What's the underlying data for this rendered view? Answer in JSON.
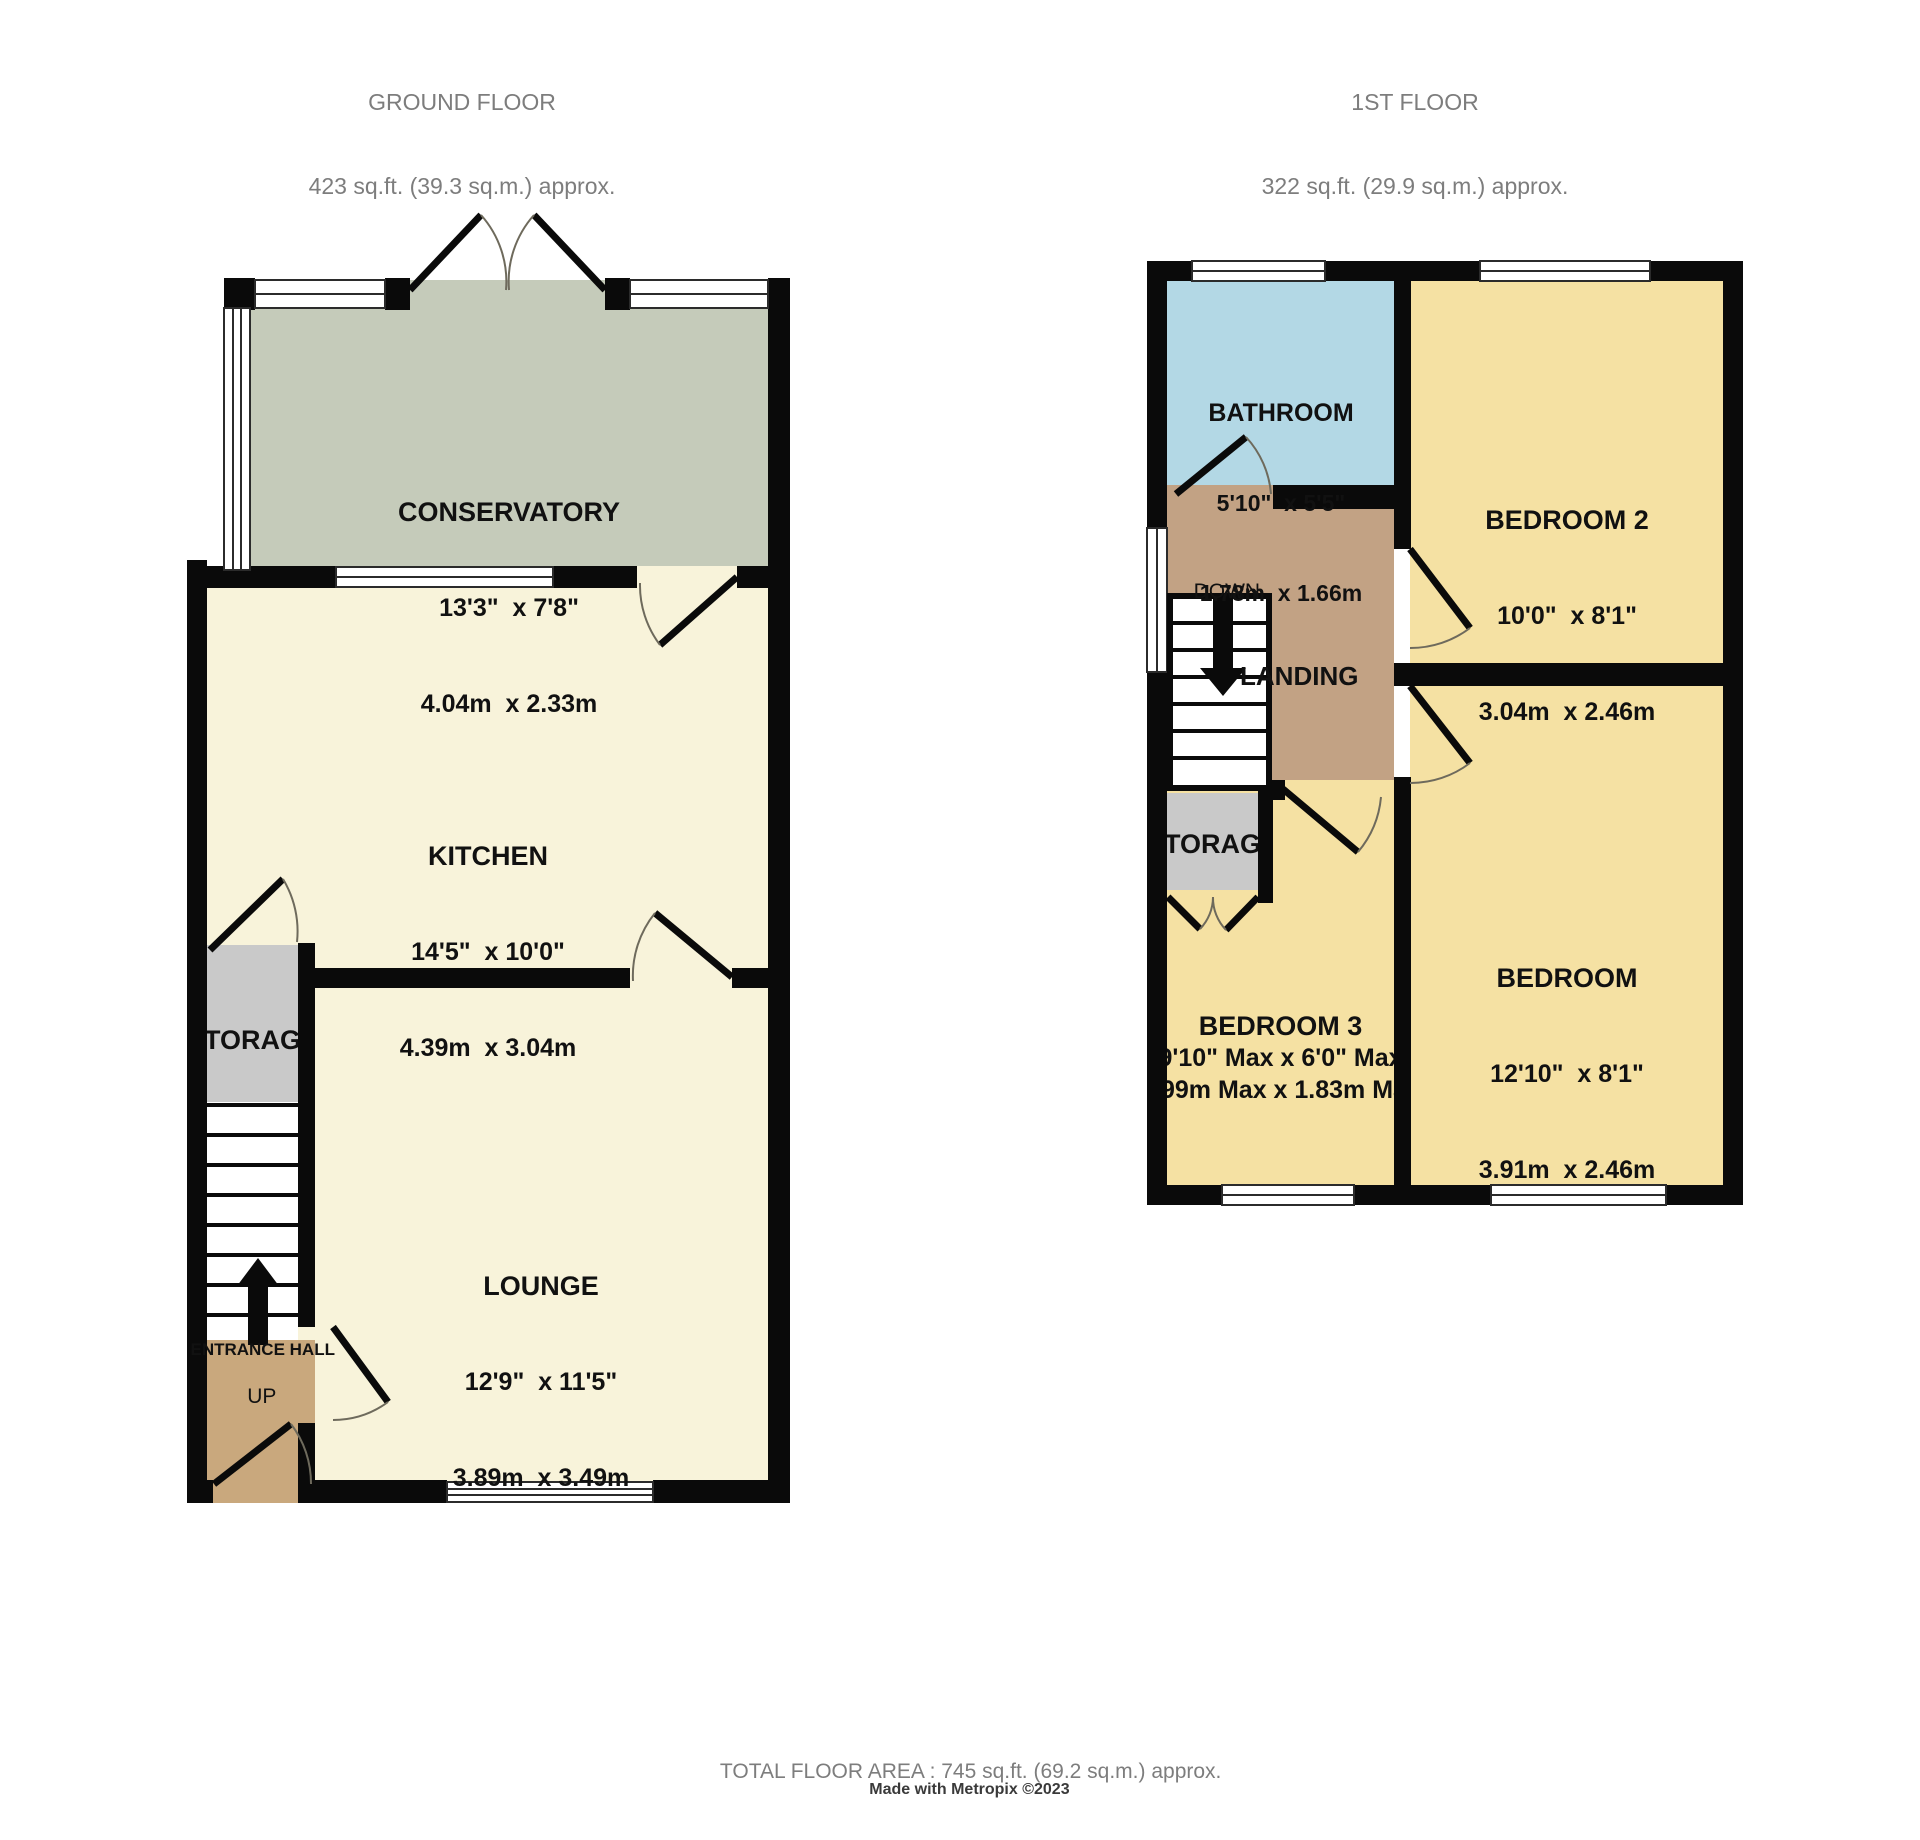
{
  "colors": {
    "wall": "#0a0a0a",
    "room_cream": "#f8f3da",
    "room_yellow": "#f5e1a3",
    "room_blue": "#b3d8e5",
    "room_green": "#c5cbba",
    "room_tan": "#c9a87d",
    "room_tan_first": "#c2a284",
    "room_grey": "#c9c9c9",
    "header_text": "#7d7d7d",
    "label_text": "#111111"
  },
  "ground_floor": {
    "title": "GROUND FLOOR",
    "area": "423 sq.ft. (39.3 sq.m.) approx.",
    "stairs_label": "UP",
    "rooms": {
      "conservatory": {
        "name": "CONSERVATORY",
        "imperial": "13'3\"  x 7'8\"",
        "metric": "4.04m  x 2.33m"
      },
      "kitchen": {
        "name": "KITCHEN",
        "imperial": "14'5\"  x 10'0\"",
        "metric": "4.39m  x 3.04m"
      },
      "lounge": {
        "name": "LOUNGE",
        "imperial": "12'9\"  x 11'5\"",
        "metric": "3.89m  x 3.49m"
      },
      "storage": {
        "name": "STORAGE"
      },
      "entrance_hall": {
        "name": "ENTRANCE HALL"
      }
    }
  },
  "first_floor": {
    "title": "1ST FLOOR",
    "area": "322 sq.ft. (29.9 sq.m.) approx.",
    "stairs_label": "DOWN",
    "rooms": {
      "bathroom": {
        "name": "BATHROOM",
        "imperial": "5'10\"  x 5'5\"",
        "metric": "1.78m  x 1.66m"
      },
      "bedroom2": {
        "name": "BEDROOM 2",
        "imperial": "10'0\"  x 8'1\"",
        "metric": "3.04m  x 2.46m"
      },
      "bedroom": {
        "name": "BEDROOM",
        "imperial": "12'10\"  x 8'1\"",
        "metric": "3.91m  x 2.46m"
      },
      "bedroom3": {
        "name": "BEDROOM 3",
        "imperial": "9'10\" Max x 6'0\" Max",
        "metric": "1.99m Max x 1.83m Max"
      },
      "landing": {
        "name": "LANDING"
      },
      "storage": {
        "name": "STORAGE"
      }
    }
  },
  "footer": {
    "total_area": "TOTAL FLOOR AREA : 745 sq.ft. (69.2 sq.m.) approx.",
    "credit": "Made with Metropix ©2023"
  }
}
